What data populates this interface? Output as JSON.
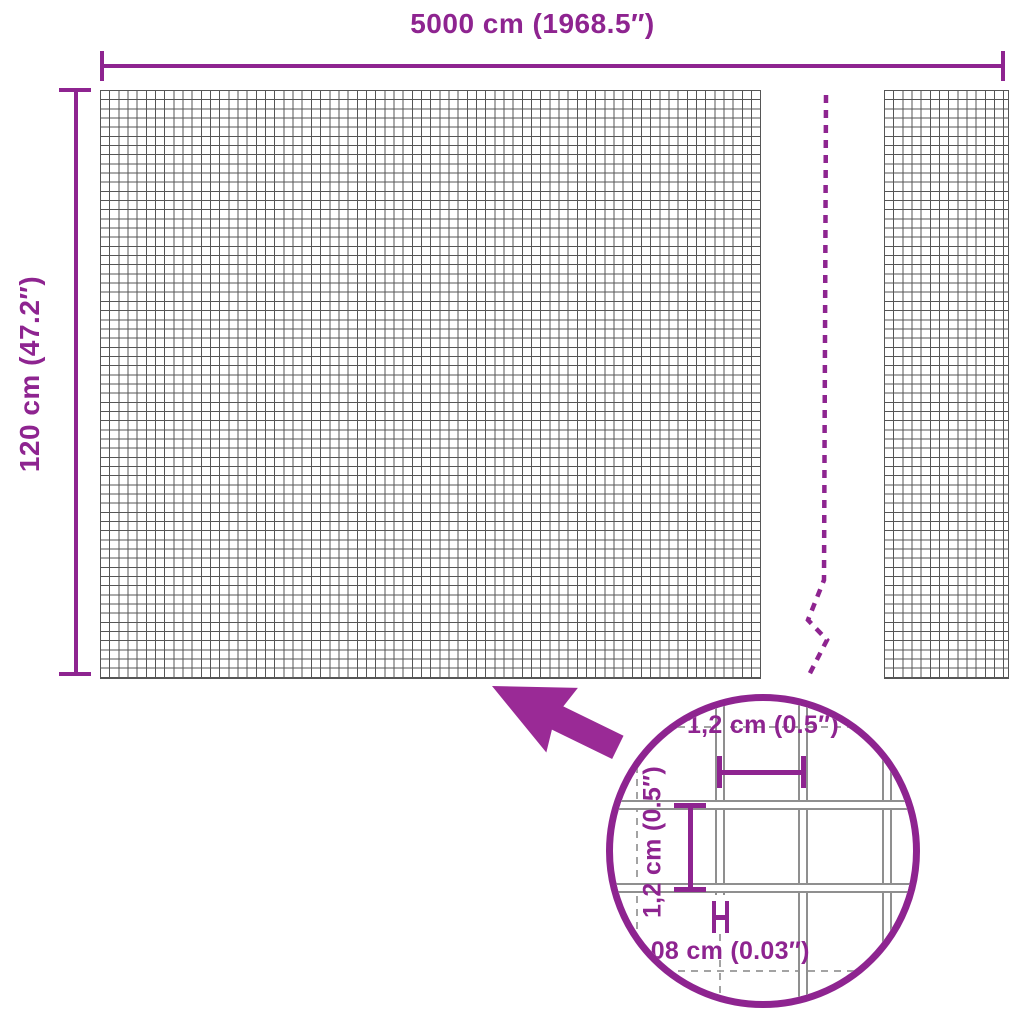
{
  "colors": {
    "accent": "#8e2490",
    "grid_line": "#565656",
    "wire_outline": "#8f8f8f",
    "hidden_wire_dash": "#a3a3a3"
  },
  "labels": {
    "total_width": "5000 cm (1968.5″)",
    "total_height": "120 cm (47.2″)",
    "mesh_pitch_horizontal": "1,2 cm (0.5″)",
    "mesh_pitch_vertical": "1,2 cm (0.5″)",
    "wire_thickness": "0,08 cm (0.03″)"
  },
  "icons": {
    "callout_arrow": "arrow-icon",
    "break_line": "break-dashed-line-icon",
    "detail_magnifier": "magnifier-circle-icon"
  }
}
